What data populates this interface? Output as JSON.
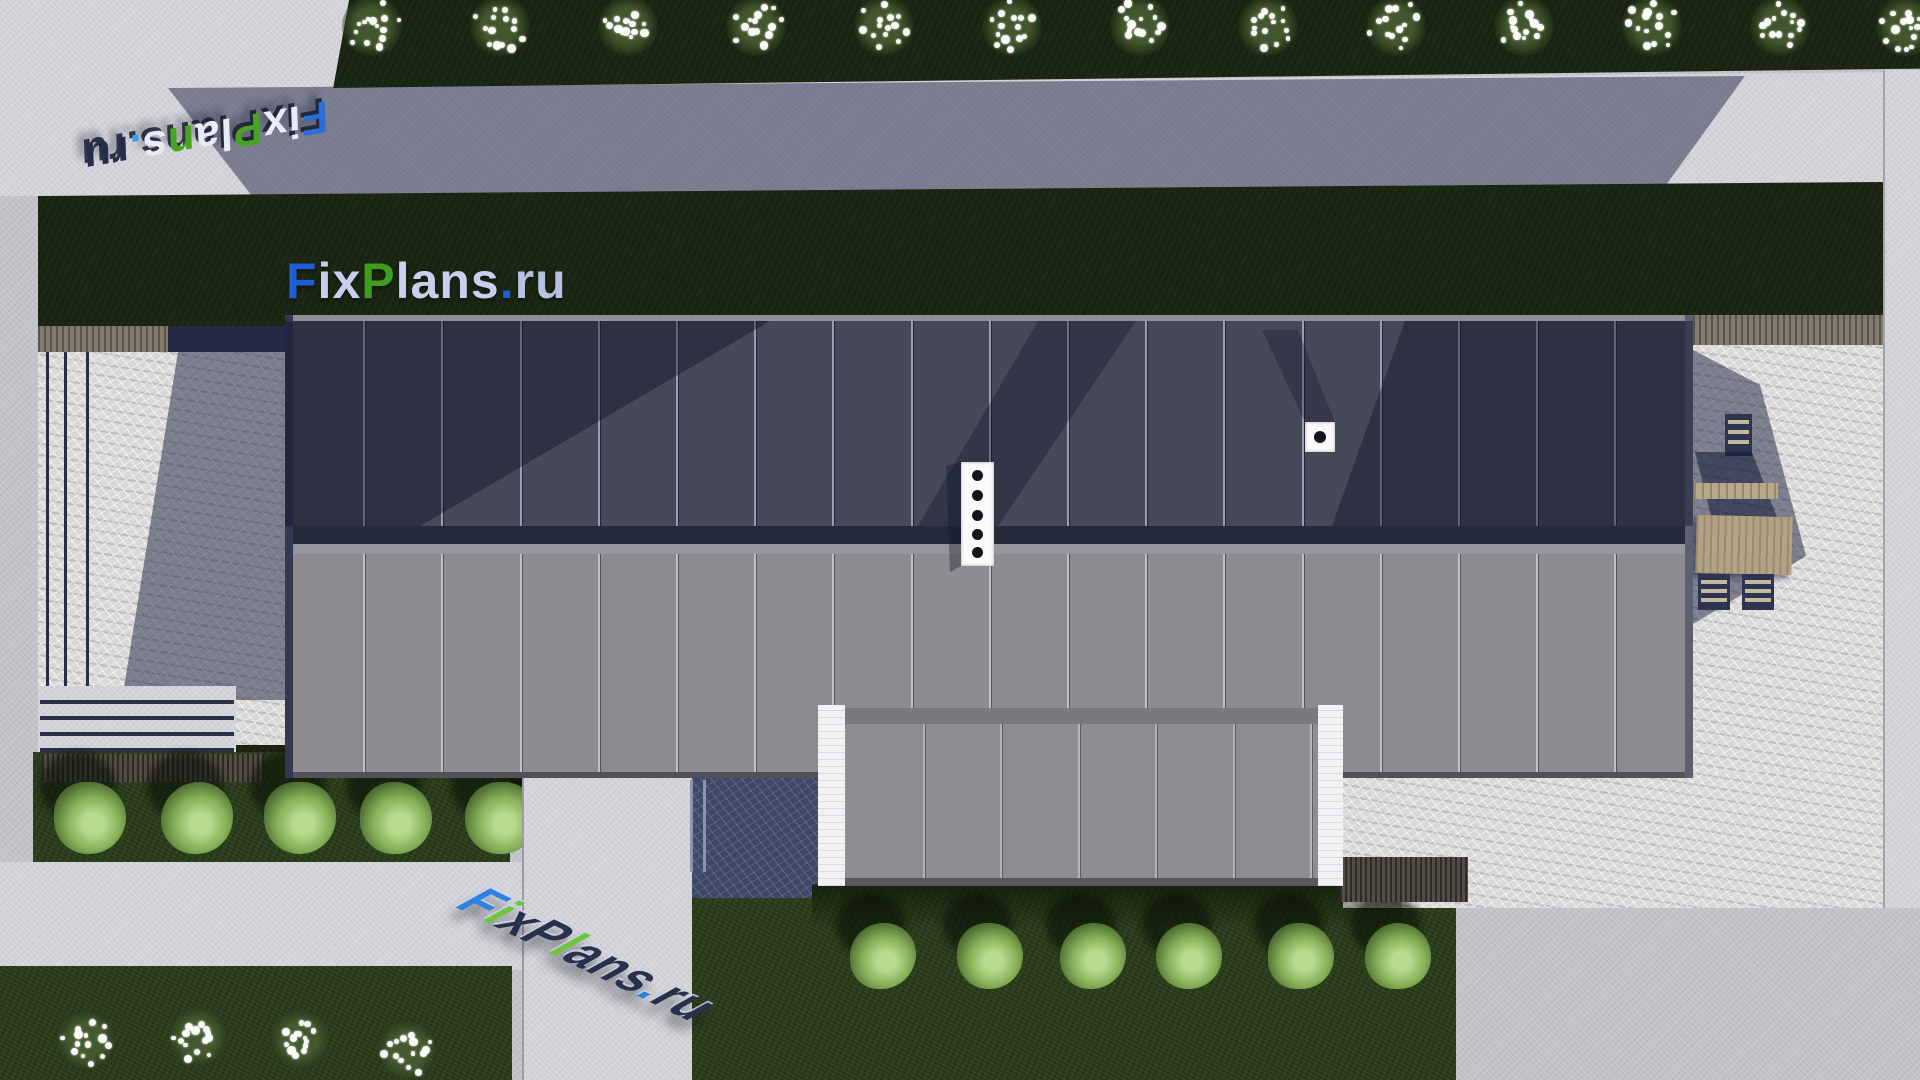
{
  "watermark": {
    "text": "FixPlans.ru",
    "main_letters": [
      [
        "F",
        "#1f5fd6"
      ],
      [
        "i",
        "#c7d0ec"
      ],
      [
        "x",
        "#c7d0ec"
      ],
      [
        "P",
        "#3f9c1e"
      ],
      [
        "l",
        "#c7d0ec"
      ],
      [
        "a",
        "#c7d0ec"
      ],
      [
        "n",
        "#c7d0ec"
      ],
      [
        "s",
        "#c7d0ec"
      ],
      [
        ".",
        "#1f5fd6"
      ],
      [
        "r",
        "#b6c2e4"
      ],
      [
        "u",
        "#b6c2e4"
      ]
    ],
    "topleft_letters": [
      [
        "F",
        "#2a6fd8"
      ],
      [
        "i",
        "#e8ecf6"
      ],
      [
        "x",
        "#e8ecf6"
      ],
      [
        "P",
        "#47a321"
      ],
      [
        "l",
        "#e8ecf6"
      ],
      [
        "a",
        "#e8ecf6"
      ],
      [
        "n",
        "#47a321"
      ],
      [
        "s",
        "#e8ecf6"
      ],
      [
        ".",
        "#3aa0e8"
      ],
      [
        "r",
        "#242e4a"
      ],
      [
        "u",
        "#242e4a"
      ]
    ],
    "bottom_letters": [
      [
        "F",
        "#2f80e2"
      ],
      [
        "i",
        "#6fc63e"
      ],
      [
        "x",
        "#28314b"
      ],
      [
        "P",
        "#28314b"
      ],
      [
        "l",
        "#6fc63e"
      ],
      [
        "a",
        "#28314b"
      ],
      [
        "n",
        "#28314b"
      ],
      [
        "s",
        "#28314b"
      ],
      [
        ".",
        "#2f80e2"
      ],
      [
        "r",
        "#28314b"
      ],
      [
        "u",
        "#28314b"
      ]
    ]
  },
  "palette": {
    "pavement": "#c2c2c9",
    "pavement_bright": "#d2d2d8",
    "stone_light": "#d9d8d7",
    "stone_shadow": "#3c4866",
    "grass_dark": "#1b2613",
    "grass_mid": "#2b3d1d",
    "roof_upper": "#454958",
    "roof_lower": "#8d8a90",
    "roof_dark_band": "#262b3b",
    "roof_gutter": "#97969f",
    "garage_panel": "#8f8c92",
    "white_wall": "#f2f2f4",
    "wood": "#817a6d",
    "furniture_wood": "#b3a285",
    "chair_navy": "#2c3450",
    "shadow_blue": "rgba(25,32,62,0.48)"
  },
  "scene": {
    "building": {
      "upper_panel_seams": 17,
      "lower_panel_seams": 17,
      "garage_panel_seams": 6,
      "roof_vent": {
        "holes": 5,
        "hole_ys_local": [
          13,
          33,
          53,
          72,
          90
        ]
      },
      "chimney": {
        "holes": 1
      }
    },
    "vegetation": {
      "top_flowers": {
        "y": 26,
        "r": 30,
        "xs": [
          372,
          500,
          628,
          756,
          884,
          1012,
          1140,
          1268,
          1396,
          1524,
          1652,
          1780,
          1906
        ]
      },
      "left_bushes": {
        "y": 818,
        "r": 36,
        "xs": [
          90,
          197,
          300,
          396,
          501
        ]
      },
      "center_bushes": {
        "y": 956,
        "r": 33,
        "xs": [
          883,
          990,
          1093,
          1189,
          1301,
          1398
        ]
      },
      "bottom_flowers": {
        "r": 30,
        "points": [
          [
            86,
            1040
          ],
          [
            198,
            1037
          ],
          [
            300,
            1039
          ],
          [
            407,
            1050
          ]
        ]
      }
    },
    "furniture": {
      "chairs": 3,
      "table": 1,
      "bench": 1
    },
    "left_patio_poles_x": [
      46,
      64,
      86
    ],
    "steps_line_ys": [
      700,
      716,
      732,
      748
    ]
  }
}
